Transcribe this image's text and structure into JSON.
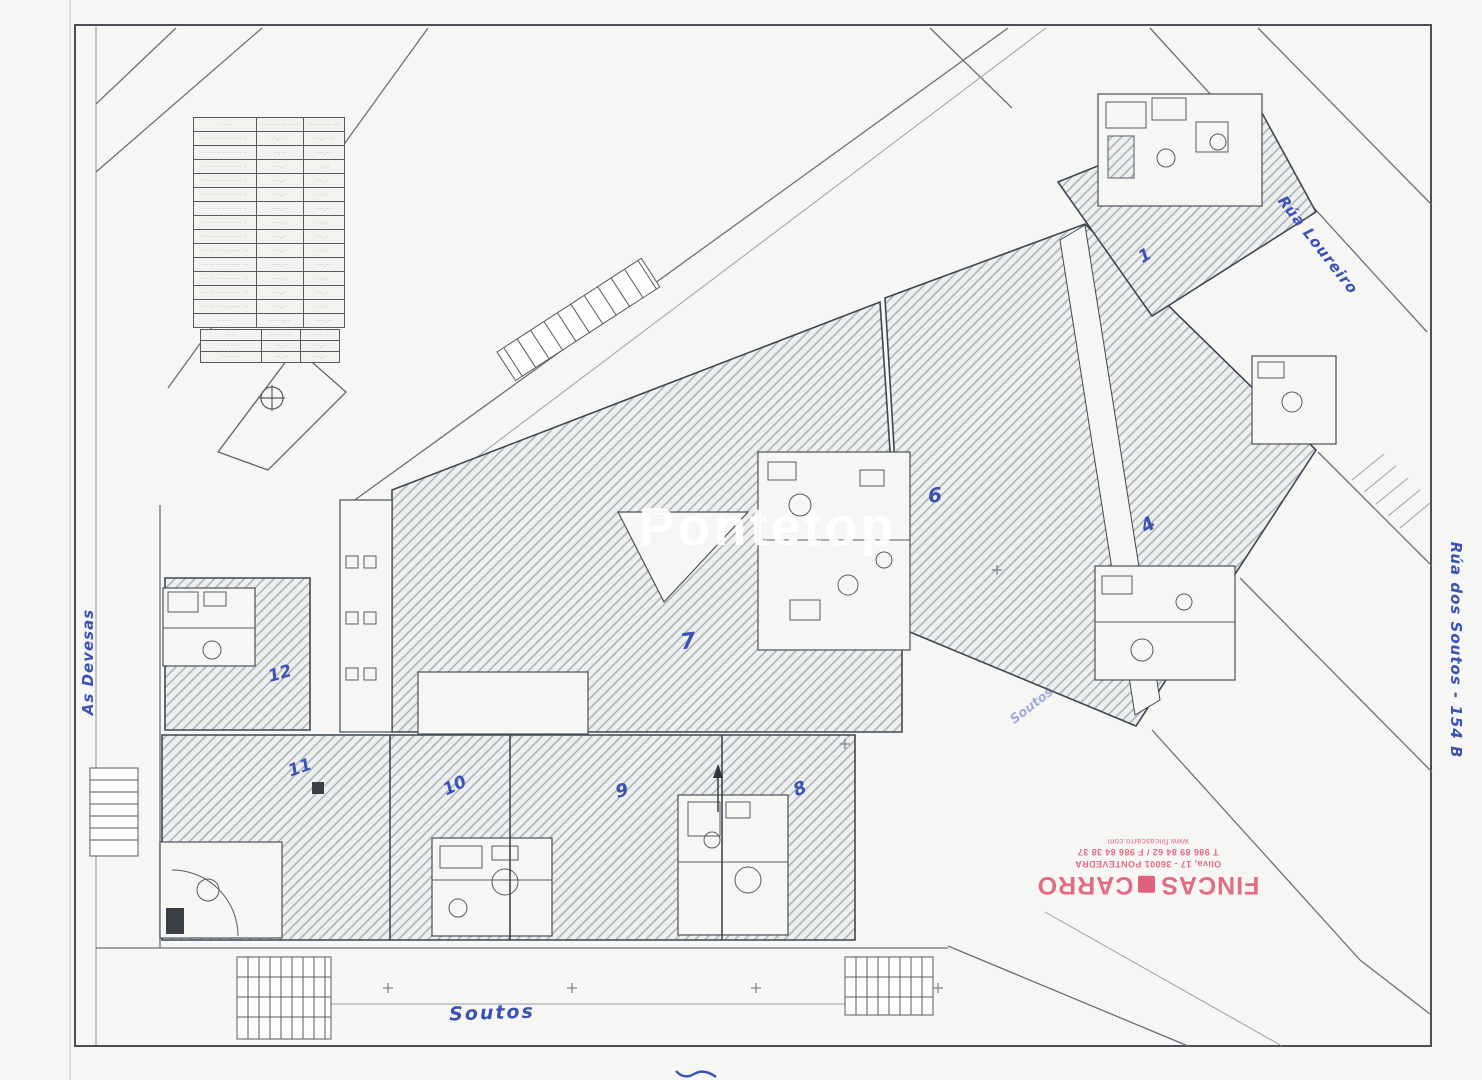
{
  "watermark": "Pontetop",
  "annotations": {
    "unit_1": "1",
    "unit_4": "4",
    "unit_6": "6",
    "unit_7": "7",
    "unit_8": "8",
    "unit_9": "9",
    "unit_10": "10",
    "unit_11": "11",
    "unit_12": "12",
    "street_top_right": "Rúa Loureiro",
    "street_right": "Rúa dos Soutos - 154 B",
    "street_left": "As Devesas",
    "street_bottom": "Soutos",
    "street_small": "Soutos"
  },
  "stamp": {
    "name_left": "FINCAS",
    "name_right": "CARRO",
    "address": "Oliva, 17 - 36001 PONTEVEDRA",
    "phone": "T 986 89 84 62 / F 986 84 38 37",
    "web": "www.fincascarro.com"
  },
  "legend_table": {
    "header": [
      "·····",
      "··········· ·····",
      "········· ···"
    ],
    "rows": [
      [
        "····· ·········· ·",
        "···,·· ··",
        "···,·· ··"
      ],
      [
        "····· ·········· ·",
        "··,··",
        "···,··"
      ],
      [
        "····· ·········· ·",
        "···,··",
        "··,··"
      ],
      [
        "····· ·········· ·",
        "···,··",
        "···,··"
      ],
      [
        "····· ·········· ·",
        "···,··",
        "···,··"
      ],
      [
        "····· ·········· ·",
        "····,··",
        "···,··"
      ],
      [
        "····· ·········· ·",
        "····,··",
        "···,··"
      ],
      [
        "····· ·········· ·",
        "···,··",
        "···,··"
      ],
      [
        "····· ·········· ··",
        "···,··",
        "···,··"
      ],
      [
        "····· ·········· ··",
        "····,··",
        "···,··"
      ],
      [
        "····· ·········· ··",
        "····,··",
        "···,··"
      ],
      [
        "····· ·········· ··",
        "···,··",
        "···,··"
      ],
      [
        "····· ·········· ··",
        "···,··",
        "···,··"
      ]
    ],
    "total_row": [
      "······",
      "·····,··",
      "····,··"
    ],
    "mini_header": [
      "····",
      "······ ··",
      "······ ··"
    ],
    "mini_rows": [
      [
        "··· ····",
        "···,··",
        "···,··"
      ],
      [
        "··· ····",
        "···,··",
        "···,··"
      ]
    ]
  }
}
